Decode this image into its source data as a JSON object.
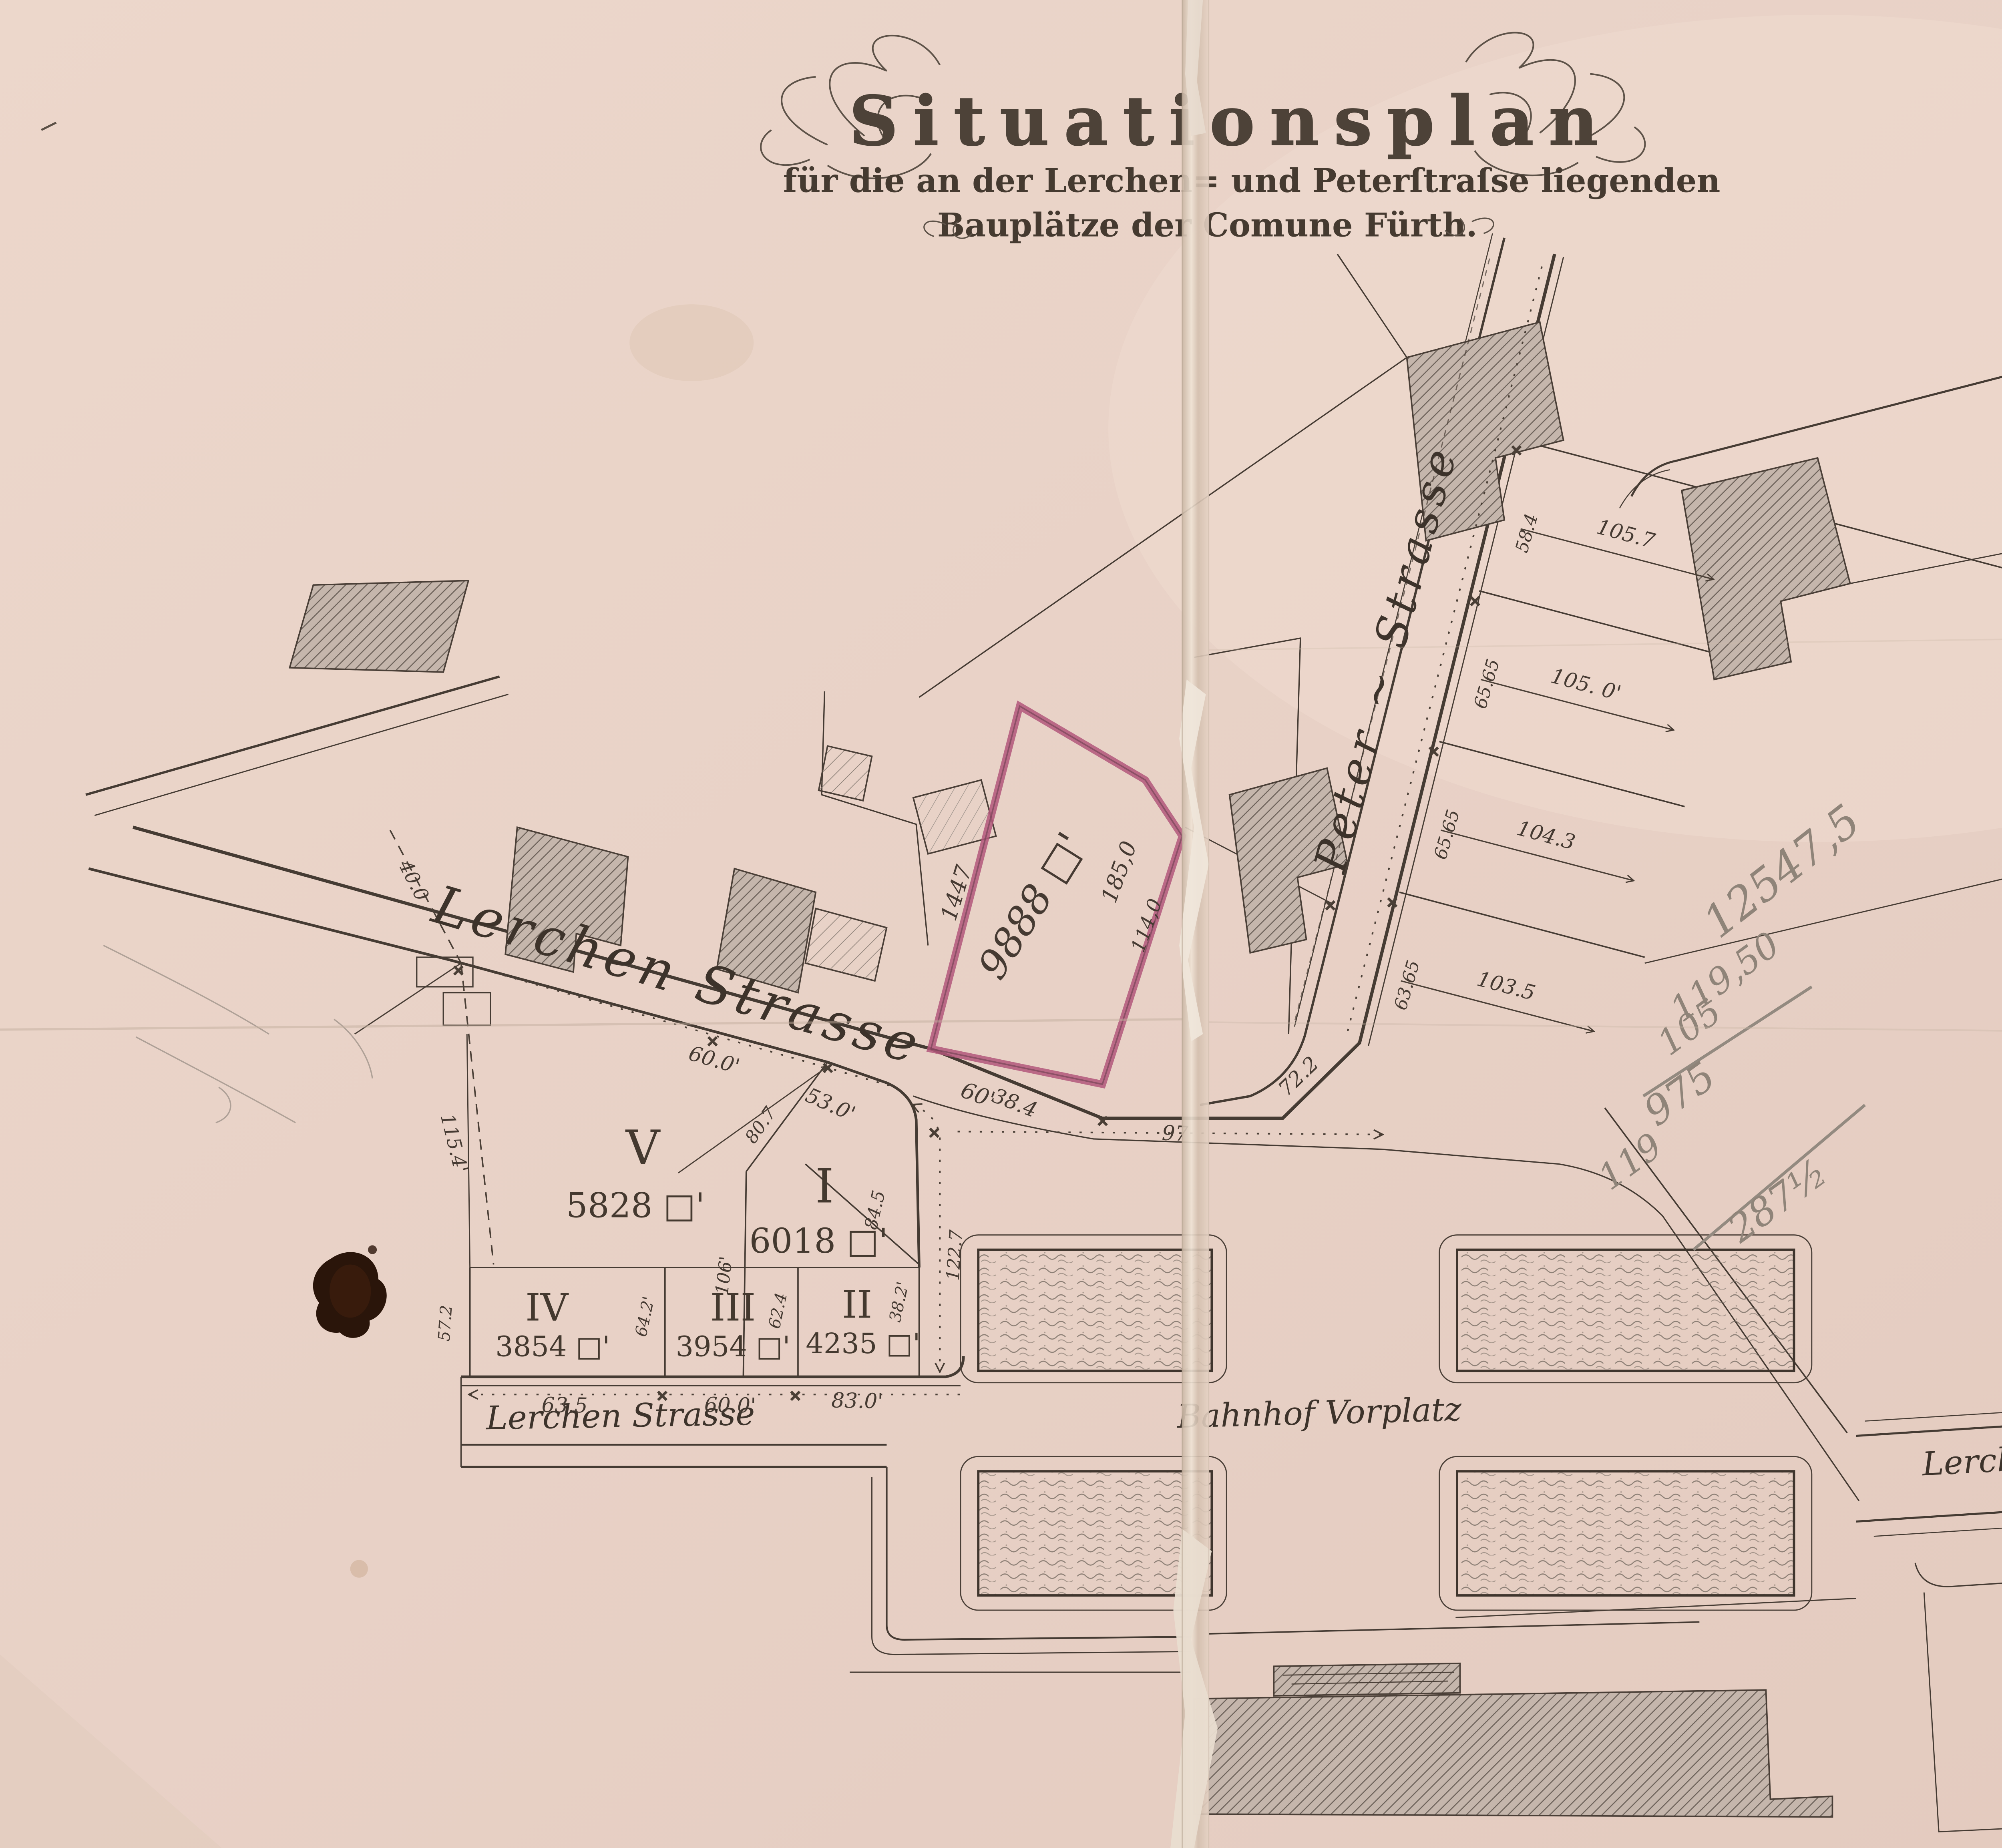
{
  "title": {
    "main": "Situationsplan",
    "line2": "für die an der Lerchen= und Peterſtraſse liegenden",
    "line3": "Bauplätze der Comune Fürth."
  },
  "streets": {
    "lerchen_upper": "Lerchen Strasse",
    "lerchen_lower": "Lerchen Strasse",
    "lerchen_right": "Lerchen Strasse",
    "peter": "Peter ~ Strasse",
    "bahnhof_vorplatz": "Bahnhof Vorplatz"
  },
  "highlighted_plot": {
    "parcel_number": "1447",
    "area": "9888 □'",
    "edge_right_outer": "185,0",
    "edge_right_inner": "114,0",
    "frontage": "60'"
  },
  "plots": {
    "v": {
      "numeral": "V",
      "area": "5828 □'"
    },
    "i": {
      "numeral": "I",
      "area": "6018 □'"
    },
    "ii": {
      "numeral": "II",
      "area": "4235 □'"
    },
    "iii": {
      "numeral": "III",
      "area": "3954 □'"
    },
    "iv": {
      "numeral": "IV",
      "area": "3854 □'"
    }
  },
  "measurements": {
    "west_upper": "40.0",
    "west_lower": "115.4'",
    "frontage_v": "60.0'",
    "frontage_i": "53.0'",
    "divider_v_i": "80.7",
    "divider_mid": "106'",
    "east_inner": "84.5",
    "east_dotted": "122.7",
    "row_west": "57.2",
    "row_div_iv_iii": "64.2'",
    "row_div_iii_ii": "62.4",
    "row_east": "38.2'",
    "bottom_iv": "63.5",
    "bottom_iii": "60.0'",
    "bottom_ii": "83.0'",
    "seg_38": "38.4",
    "seg_97": "97",
    "seg_72": "72.2"
  },
  "peter_plots": {
    "frontages": [
      "63.65",
      "65.65",
      "65.65",
      "58.4"
    ],
    "depths": [
      "103.5",
      "104.3",
      "105. 0'",
      "105.7"
    ]
  },
  "pencil_notes": {
    "total": "12547,5",
    "n1": "119,50",
    "n2": "105",
    "n3": "975",
    "n4": "119",
    "n5": "287½"
  }
}
